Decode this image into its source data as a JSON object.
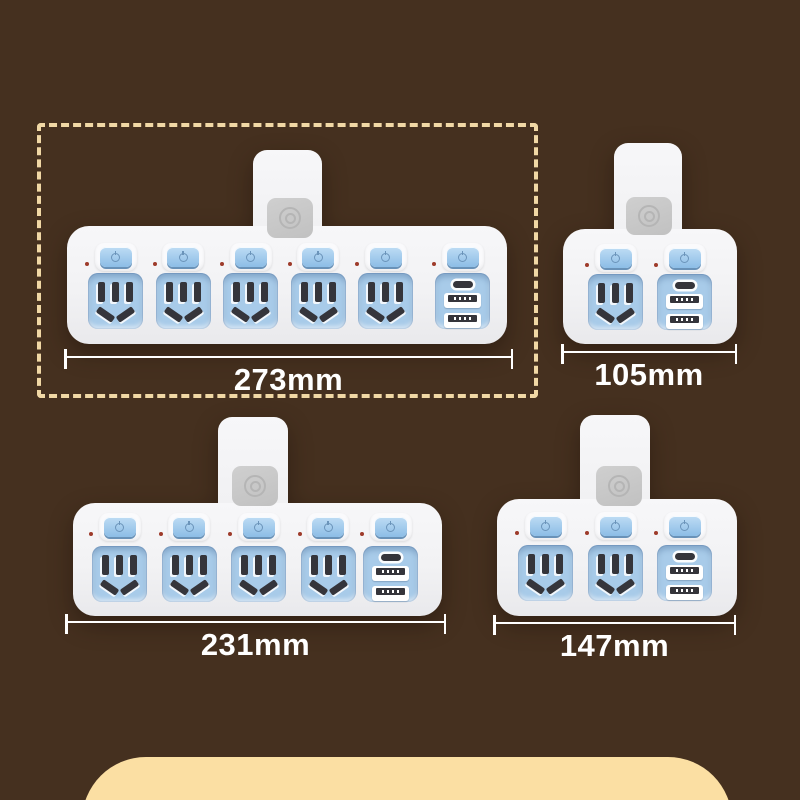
{
  "products": [
    {
      "name": "six-way-adapter",
      "size_label": "273mm",
      "ac_sockets": 5,
      "switches": 6,
      "usb_module": {
        "usb_c_ports": 1,
        "usb_a_ports": 2
      },
      "highlighted": true
    },
    {
      "name": "two-way-adapter",
      "size_label": "105mm",
      "ac_sockets": 1,
      "switches": 2,
      "usb_module": {
        "usb_c_ports": 1,
        "usb_a_ports": 2
      },
      "highlighted": false
    },
    {
      "name": "five-way-adapter",
      "size_label": "231mm",
      "ac_sockets": 4,
      "switches": 5,
      "usb_module": {
        "usb_c_ports": 1,
        "usb_a_ports": 2
      },
      "highlighted": false
    },
    {
      "name": "three-way-adapter",
      "size_label": "147mm",
      "ac_sockets": 2,
      "switches": 3,
      "usb_module": {
        "usb_c_ports": 1,
        "usb_a_ports": 2
      },
      "highlighted": false
    }
  ],
  "colors": {
    "background": "#45301f",
    "panel": "#fbdfa3",
    "highlight_border": "#f1d8a5",
    "device_body": "#f2f2f4",
    "socket_blue": "#a8cbe9",
    "switch_blue": "#9cc6ea",
    "slot_dark": "#35353b",
    "plug_gray": "#c7c7c7",
    "indicator_red": "#9e3b2b",
    "dimension": "#ffffff"
  }
}
